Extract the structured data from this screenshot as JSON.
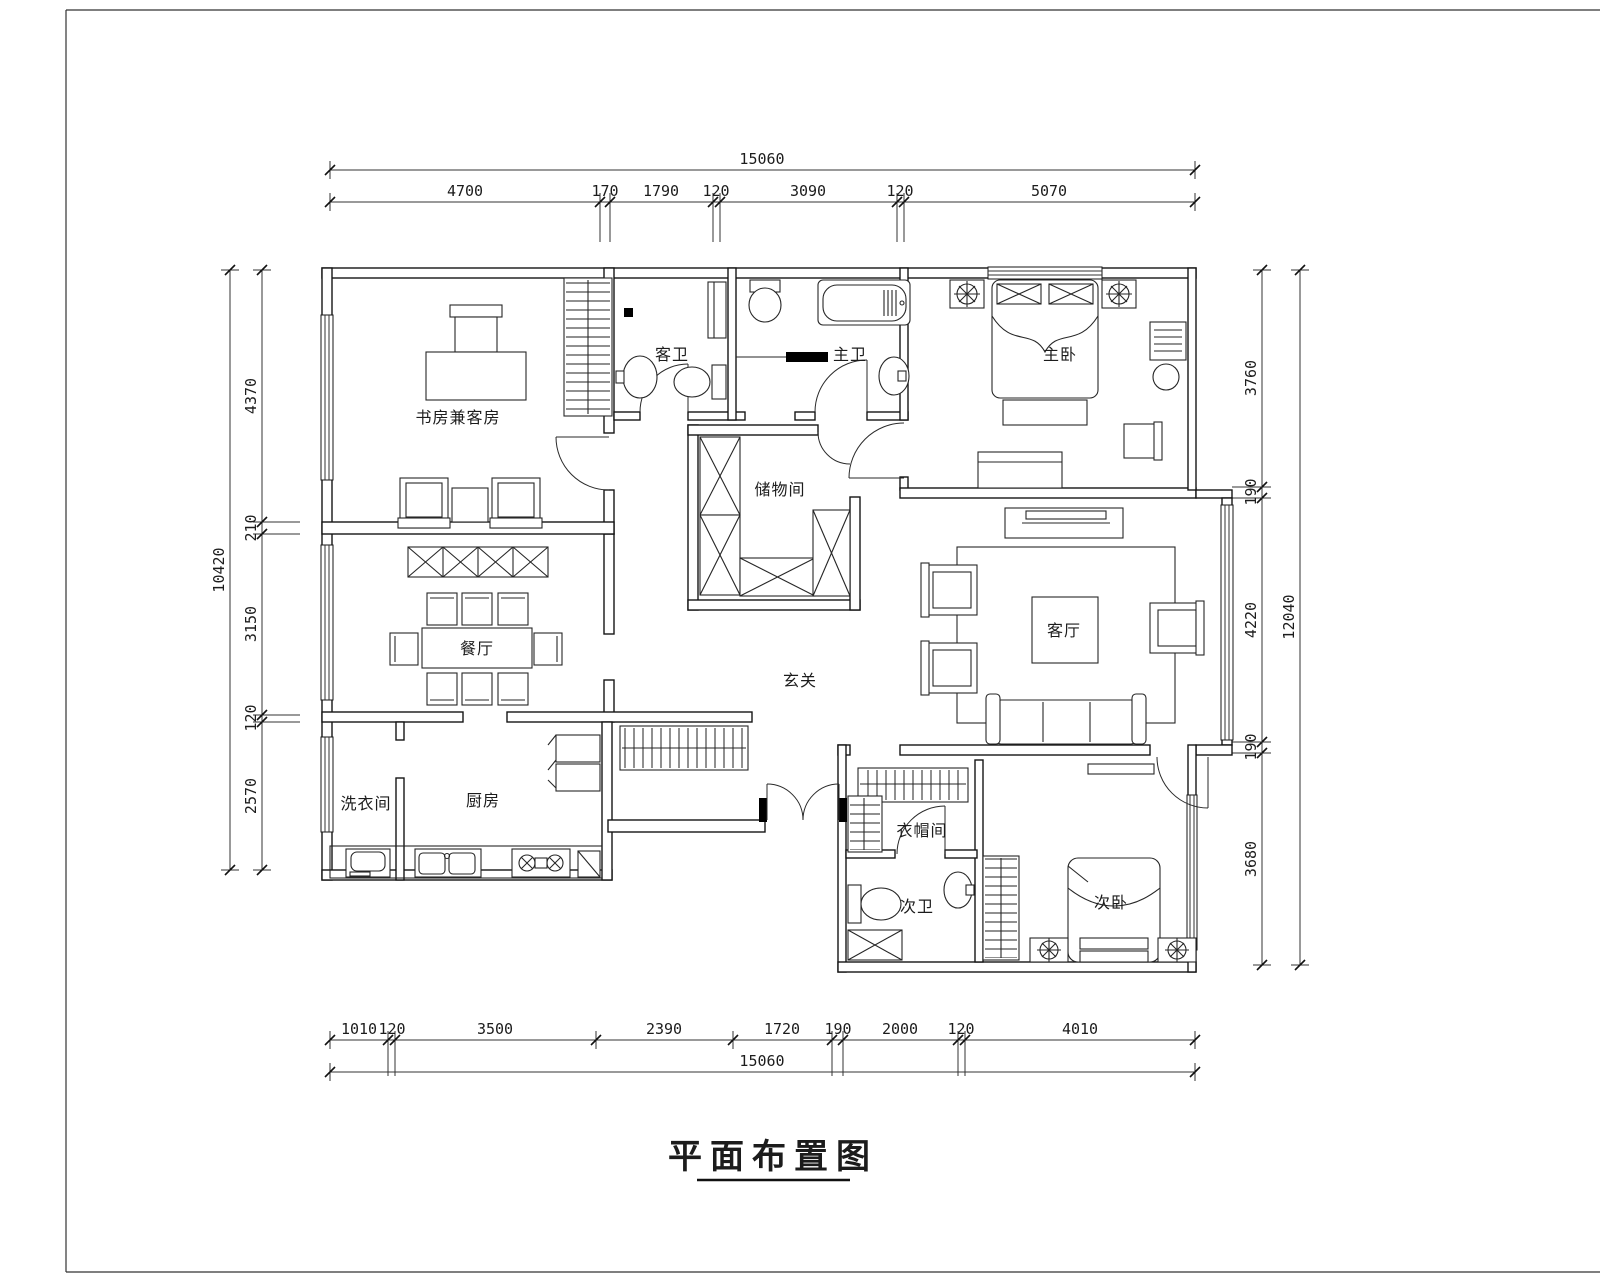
{
  "drawing": {
    "title": "平面布置图"
  },
  "rooms": {
    "study": "书房兼客房",
    "guest_bath": "客卫",
    "master_bath": "主卫",
    "master_bedroom": "主卧",
    "storage": "储物间",
    "dining": "餐厅",
    "foyer": "玄关",
    "living": "客厅",
    "laundry": "洗衣间",
    "kitchen": "厨房",
    "cloakroom": "衣帽间",
    "second_bath": "次卫",
    "second_bedroom": "次卧"
  },
  "dimensions": {
    "top": {
      "total": "15060",
      "segments": [
        "4700",
        "170",
        "1790",
        "120",
        "3090",
        "120",
        "5070"
      ]
    },
    "bottom": {
      "total": "15060",
      "segments": [
        "1010",
        "120",
        "3500",
        "2390",
        "1720",
        "190",
        "2000",
        "120",
        "4010"
      ]
    },
    "left": {
      "total": "10420",
      "segments": [
        "4370",
        "210",
        "3150",
        "120",
        "2570"
      ]
    },
    "right": {
      "total": "12040",
      "segments": [
        "3760",
        "190",
        "4220",
        "190",
        "3680"
      ]
    }
  },
  "colors": {
    "line": "#1c1c1c",
    "background": "#ffffff"
  }
}
